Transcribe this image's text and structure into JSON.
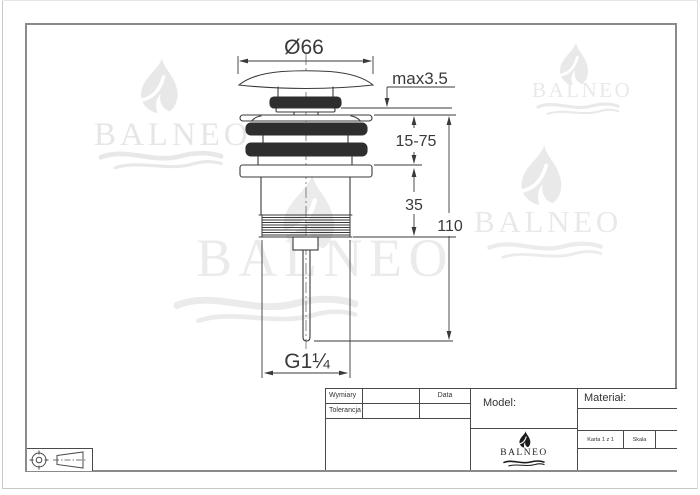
{
  "brand": {
    "name": "BALNEO"
  },
  "drawing": {
    "dimensions": {
      "diameter": "Ø66",
      "cap_clearance": "max3.5",
      "clamping_range": "15-75",
      "body_height": "35",
      "total_height": "110",
      "thread": "G1¼"
    }
  },
  "title_block": {
    "wymiary": "Wymiary",
    "tolerancja": "Tolerancja",
    "data": "Data",
    "model": "Model:",
    "material": "Materiał:",
    "karta": "Karta 1 z 1",
    "skala": "Skala"
  },
  "colors": {
    "line": "#3a3a3a",
    "dark_fill": "#2e2e2e",
    "watermark": "#e8e8e8",
    "frame": "#8a8a8a"
  }
}
